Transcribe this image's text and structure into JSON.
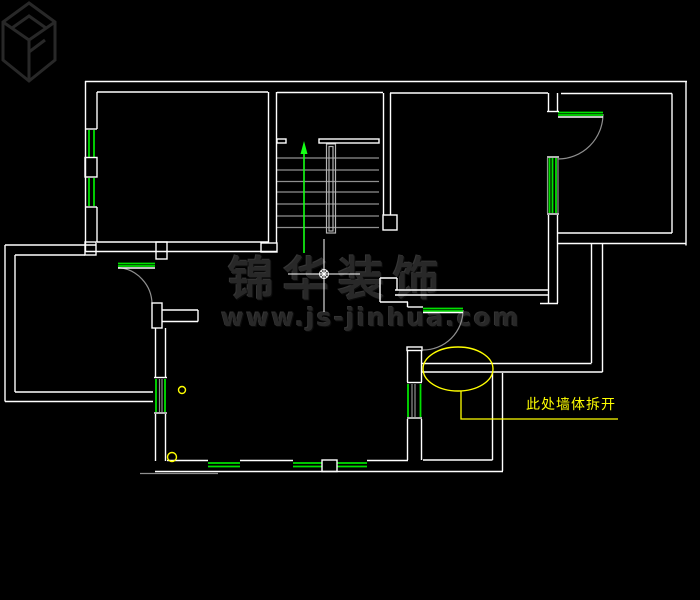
{
  "canvas": {
    "width": 700,
    "height": 600,
    "background": "#000000"
  },
  "palette": {
    "wall": "#ffffff",
    "detail_gray": "#8f8f8f",
    "rail_gray": "#b4b4b4",
    "window_green": "#00e100",
    "arrow_green": "#15ff15",
    "highlight_yellow": "#ffff00",
    "watermark_gray": "#282828"
  },
  "watermark": {
    "brand": "锦华装饰",
    "url": "www.js-jinhua.com"
  },
  "annotation": {
    "label": "此处墙体拆开"
  },
  "floorplan": {
    "wall_lines": [
      [
        85,
        81.5,
        687,
        81.5
      ],
      [
        97,
        92,
        268,
        92
      ],
      [
        277,
        92.5,
        383,
        92.5
      ],
      [
        390,
        93,
        548,
        93
      ],
      [
        561,
        93.5,
        672,
        93.5
      ],
      [
        85.5,
        81,
        85.5,
        252
      ],
      [
        97,
        92,
        97,
        129
      ],
      [
        97,
        207,
        97,
        242
      ],
      [
        85,
        129,
        97,
        129
      ],
      [
        85,
        207,
        97,
        207
      ],
      [
        97,
        242,
        268,
        242
      ],
      [
        85,
        251.5,
        277,
        251.5
      ],
      [
        268.5,
        92,
        268.5,
        243
      ],
      [
        276.5,
        92,
        276.5,
        243
      ],
      [
        383.5,
        93,
        383.5,
        215
      ],
      [
        390.5,
        93,
        390.5,
        215
      ],
      [
        395,
        290,
        548,
        290
      ],
      [
        395,
        295,
        548,
        295
      ],
      [
        380,
        278,
        397,
        278
      ],
      [
        380,
        278,
        380,
        302
      ],
      [
        397,
        278,
        397,
        290
      ],
      [
        380,
        302,
        408,
        302
      ],
      [
        407.5,
        302,
        407.5,
        307
      ],
      [
        407.5,
        307,
        423,
        307
      ],
      [
        548.5,
        93,
        548.5,
        111
      ],
      [
        557.5,
        93,
        557.5,
        111
      ],
      [
        547,
        111.5,
        559,
        111.5
      ],
      [
        547,
        157,
        559,
        157
      ],
      [
        547,
        214,
        559,
        214
      ],
      [
        548.5,
        215,
        548.5,
        303
      ],
      [
        557.5,
        215,
        557.5,
        303
      ],
      [
        540,
        303.5,
        558,
        303.5
      ],
      [
        686,
        81.5,
        686,
        245.5
      ],
      [
        672,
        93.5,
        672,
        233
      ],
      [
        558,
        233,
        672,
        233
      ],
      [
        558,
        243.5,
        686,
        243.5
      ],
      [
        591.5,
        243.5,
        591.5,
        363
      ],
      [
        602.5,
        243.5,
        602.5,
        372
      ],
      [
        422,
        363.5,
        591.5,
        363.5
      ],
      [
        422,
        372,
        602.5,
        372
      ],
      [
        407.5,
        350,
        407.5,
        382
      ],
      [
        421.5,
        350,
        421.5,
        382
      ],
      [
        407,
        382.5,
        422,
        382.5
      ],
      [
        407,
        418,
        422,
        418
      ],
      [
        407.5,
        419,
        407.5,
        460
      ],
      [
        421.5,
        419,
        421.5,
        460
      ],
      [
        492.5,
        373,
        492.5,
        460
      ],
      [
        502.5,
        373,
        502.5,
        471
      ],
      [
        423,
        460,
        492.5,
        460
      ],
      [
        155,
        471.5,
        503,
        471.5
      ],
      [
        167,
        460.5,
        208,
        460.5
      ],
      [
        240,
        460.5,
        293,
        460.5
      ],
      [
        367,
        460.5,
        408,
        460.5
      ],
      [
        162,
        310,
        198,
        310
      ],
      [
        162,
        321.5,
        198,
        321.5
      ],
      [
        198,
        310,
        198,
        321.5
      ],
      [
        155.5,
        328,
        155.5,
        377
      ],
      [
        165.5,
        328,
        165.5,
        377
      ],
      [
        154,
        377.5,
        167,
        377.5
      ],
      [
        154,
        413,
        167,
        413
      ],
      [
        155.5,
        414,
        155.5,
        461
      ],
      [
        165.5,
        414,
        165.5,
        461
      ],
      [
        5,
        245,
        96,
        245
      ],
      [
        15,
        255,
        85,
        255
      ],
      [
        5,
        245,
        5,
        401.5
      ],
      [
        15,
        255,
        15,
        392
      ],
      [
        5,
        401.5,
        153,
        401.5
      ],
      [
        15,
        392,
        153,
        392
      ],
      [
        118,
        268,
        155,
        268
      ],
      [
        558,
        117,
        603,
        117
      ],
      [
        423,
        312.5,
        463,
        312.5
      ]
    ],
    "wall_boxes": [
      [
        85,
        157.5,
        12,
        19.5
      ],
      [
        156,
        242,
        11,
        17
      ],
      [
        261,
        243,
        16,
        9
      ],
      [
        383,
        215,
        14,
        15
      ],
      [
        319,
        139,
        60,
        4
      ],
      [
        277,
        139,
        9,
        4
      ],
      [
        407,
        347,
        15,
        3.5
      ],
      [
        322,
        460,
        15,
        11.5
      ],
      [
        152,
        303,
        10,
        25
      ],
      [
        85,
        242,
        11,
        13
      ]
    ],
    "detail_lines": [
      [
        277,
        158,
        379,
        158
      ],
      [
        277,
        170,
        379,
        170
      ],
      [
        277,
        181.5,
        379,
        181.5
      ],
      [
        277,
        192,
        379,
        192
      ],
      [
        277,
        204,
        379,
        204
      ],
      [
        277,
        216,
        379,
        216
      ],
      [
        277,
        227.5,
        379,
        227.5
      ],
      [
        140,
        473.5,
        218,
        473.5
      ],
      [
        159.5,
        379,
        159.5,
        412
      ],
      [
        162,
        379,
        162,
        412
      ],
      [
        412,
        384,
        412,
        417
      ],
      [
        415,
        384,
        415,
        417
      ],
      [
        547.5,
        158,
        547.5,
        213
      ],
      [
        558,
        158,
        558,
        213
      ]
    ],
    "detail_boxes": [
      [
        326.5,
        144,
        9,
        89
      ],
      [
        329,
        146.5,
        4,
        84.5
      ]
    ],
    "door_arcs": [
      "M 118 267.5 A 37 37 0 0 1 152 304",
      "M 603 114 A 45 45 0 0 1 558 159",
      "M 463 310 A 40 40 0 0 1 423 350"
    ],
    "window_lines": [
      [
        89,
        130,
        89,
        157
      ],
      [
        94,
        130,
        94,
        157
      ],
      [
        89,
        178,
        89,
        206
      ],
      [
        94,
        178,
        94,
        206
      ],
      [
        549.5,
        158,
        549.5,
        213
      ],
      [
        552.5,
        158,
        552.5,
        213
      ],
      [
        556,
        158,
        556,
        213
      ],
      [
        156,
        379,
        156,
        412
      ],
      [
        165,
        379,
        165,
        412
      ],
      [
        408,
        384,
        408,
        417
      ],
      [
        420.5,
        384,
        420.5,
        417
      ],
      [
        208,
        463,
        240,
        463
      ],
      [
        208,
        466.5,
        240,
        466.5
      ],
      [
        293,
        463,
        322,
        463
      ],
      [
        293,
        466.5,
        322,
        466.5
      ],
      [
        337,
        463,
        367,
        463
      ],
      [
        337,
        466.5,
        367,
        466.5
      ],
      [
        118,
        263.5,
        155,
        263.5
      ],
      [
        118,
        266,
        155,
        266
      ],
      [
        558,
        112.5,
        603,
        112.5
      ],
      [
        558,
        115,
        603,
        115
      ],
      [
        423,
        308.5,
        463,
        308.5
      ],
      [
        423,
        311,
        463,
        311
      ]
    ],
    "thin_lines": [
      [
        324,
        239,
        324,
        312
      ],
      [
        288,
        274,
        360,
        274
      ],
      [
        321,
        271,
        327,
        277
      ],
      [
        327,
        271,
        321,
        277
      ]
    ],
    "center_circle": [
      324,
      274,
      4.5
    ],
    "arrow_line": [
      304,
      152,
      304,
      253
    ],
    "arrow_head": "304,141 300.5,154 307.5,154",
    "ellipse": [
      458,
      369,
      35,
      22
    ],
    "leader": "461,391 461,419 618,419",
    "marker_circles": [
      [
        182,
        390,
        3.5
      ],
      [
        172,
        457,
        4.5
      ]
    ]
  }
}
